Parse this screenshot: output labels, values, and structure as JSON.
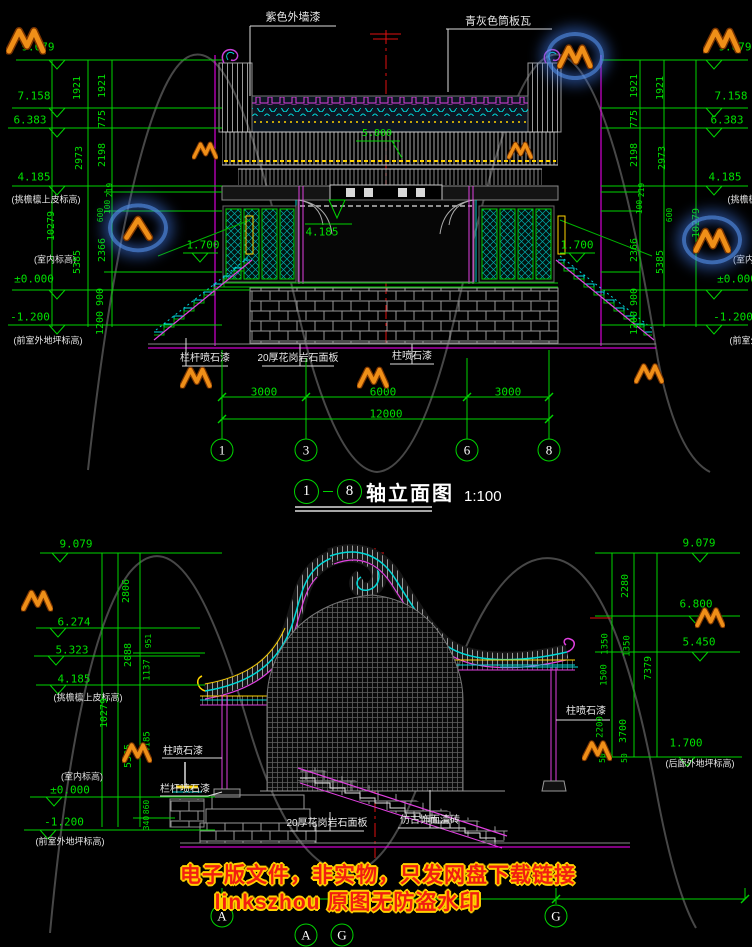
{
  "titles": {
    "top": {
      "from": "1",
      "to": "8",
      "text": "轴立面图",
      "scale": "1:100"
    }
  },
  "axes": {
    "top": [
      {
        "label": "1",
        "x": 222
      },
      {
        "label": "3",
        "x": 306
      },
      {
        "label": "6",
        "x": 467
      },
      {
        "label": "8",
        "x": 549
      }
    ],
    "top_y": 450,
    "bottom": [
      {
        "label": "A",
        "x": 222,
        "y": 916
      },
      {
        "label": "G",
        "x": 556,
        "y": 916
      },
      {
        "label": "A",
        "x": 306,
        "y": 935
      },
      {
        "label": "G",
        "x": 342,
        "y": 935
      }
    ]
  },
  "watermark": {
    "line1": "电子版文件，非实物，只发网盘下载链接",
    "line2": "linkszhou 原图无防盗水印",
    "logo_color": "#ef8f18",
    "glow_color": "#4a86d8",
    "logos": [
      {
        "x": 26,
        "y": 40,
        "s": 40
      },
      {
        "x": 575,
        "y": 56,
        "s": 36,
        "glow": 1
      },
      {
        "x": 722,
        "y": 40,
        "s": 38
      },
      {
        "x": 205,
        "y": 150,
        "s": 26
      },
      {
        "x": 520,
        "y": 150,
        "s": 26
      },
      {
        "x": 138,
        "y": 228,
        "s": 38,
        "glow": 1,
        "type": "chev"
      },
      {
        "x": 712,
        "y": 240,
        "s": 38,
        "glow": 1
      },
      {
        "x": 196,
        "y": 377,
        "s": 32
      },
      {
        "x": 373,
        "y": 377,
        "s": 32
      },
      {
        "x": 649,
        "y": 373,
        "s": 30
      },
      {
        "x": 37,
        "y": 600,
        "s": 32
      },
      {
        "x": 137,
        "y": 752,
        "s": 30
      },
      {
        "x": 597,
        "y": 750,
        "s": 30
      },
      {
        "x": 710,
        "y": 617,
        "s": 30
      }
    ]
  },
  "annotations": [
    {
      "n": "label-purple-wall-paint",
      "t": "紫色外墙漆",
      "x": 293,
      "y": 18,
      "c": "w",
      "s": 11
    },
    {
      "n": "label-grey-tube-tile",
      "t": "青灰色筒板瓦",
      "x": 498,
      "y": 22,
      "c": "w",
      "s": 11
    },
    {
      "n": "level-top-left-9079",
      "t": "9.079",
      "x": 38,
      "y": 47,
      "c": "gl"
    },
    {
      "n": "level-top-left-7158",
      "t": "7.158",
      "x": 34,
      "y": 96,
      "c": "gl"
    },
    {
      "n": "level-top-left-6383",
      "t": "6.383",
      "x": 30,
      "y": 120,
      "c": "gl"
    },
    {
      "n": "level-top-left-4185",
      "t": "4.185",
      "x": 34,
      "y": 177,
      "c": "gl"
    },
    {
      "n": "note-top-left-eave",
      "t": "(挑檐檩上皮标高)",
      "x": 46,
      "y": 200,
      "c": "w",
      "s": 9
    },
    {
      "n": "note-top-left-indoor",
      "t": "(室内标高)",
      "x": 55,
      "y": 260,
      "c": "w",
      "s": 9
    },
    {
      "n": "level-top-left-0000",
      "t": "±0.000",
      "x": 34,
      "y": 279,
      "c": "gl"
    },
    {
      "n": "level-top-left-m1200",
      "t": "-1.200",
      "x": 30,
      "y": 317,
      "c": "gl"
    },
    {
      "n": "note-top-left-ground",
      "t": "(前室外地坪标高)",
      "x": 48,
      "y": 341,
      "c": "w",
      "s": 9
    },
    {
      "n": "dim-top-left",
      "t": "1921",
      "x": 78,
      "y": 88,
      "r": 1
    },
    {
      "n": "dim-top-left",
      "t": "2973",
      "x": 80,
      "y": 158,
      "r": 1
    },
    {
      "n": "dim-top-left",
      "t": "5385",
      "x": 78,
      "y": 262,
      "r": 1
    },
    {
      "n": "dim-top-left-total",
      "t": "10279",
      "x": 52,
      "y": 226,
      "r": 1
    },
    {
      "n": "dim-top-left",
      "t": "1921",
      "x": 103,
      "y": 86,
      "r": 1
    },
    {
      "n": "dim-top-left",
      "t": "775",
      "x": 103,
      "y": 119,
      "r": 1
    },
    {
      "n": "dim-top-left",
      "t": "2198",
      "x": 103,
      "y": 155,
      "r": 1
    },
    {
      "n": "dim-top-left",
      "t": "219",
      "x": 110,
      "y": 190,
      "r": 1,
      "s": 8
    },
    {
      "n": "dim-top-left",
      "t": "100",
      "x": 108,
      "y": 207,
      "r": 1,
      "s": 8
    },
    {
      "n": "dim-top-left",
      "t": "600",
      "x": 101,
      "y": 215,
      "r": 1,
      "s": 8
    },
    {
      "n": "dim-top-left",
      "t": "2366",
      "x": 103,
      "y": 250,
      "r": 1
    },
    {
      "n": "dim-top-left",
      "t": "900",
      "x": 101,
      "y": 297,
      "r": 1
    },
    {
      "n": "dim-top-left",
      "t": "1200",
      "x": 101,
      "y": 323,
      "r": 1
    },
    {
      "n": "level-top-right-9079",
      "t": "9.079",
      "x": 735,
      "y": 47,
      "c": "gl"
    },
    {
      "n": "level-top-right-7158",
      "t": "7.158",
      "x": 731,
      "y": 96,
      "c": "gl"
    },
    {
      "n": "level-top-right-6383",
      "t": "6.383",
      "x": 727,
      "y": 120,
      "c": "gl"
    },
    {
      "n": "level-top-right-4185",
      "t": "4.185",
      "x": 725,
      "y": 177,
      "c": "gl"
    },
    {
      "n": "note-top-right-eave",
      "t": "(挑檐檩上皮标高)",
      "x": 762,
      "y": 200,
      "c": "w",
      "s": 9
    },
    {
      "n": "note-top-right-indoor",
      "t": "(室内标高)",
      "x": 754,
      "y": 260,
      "c": "w",
      "s": 9
    },
    {
      "n": "level-top-right-0000",
      "t": "±0.000",
      "x": 737,
      "y": 279,
      "c": "gl"
    },
    {
      "n": "level-top-right-m1200",
      "t": "-1.200",
      "x": 733,
      "y": 317,
      "c": "gl"
    },
    {
      "n": "note-top-right-ground",
      "t": "(前室外地坪标高)",
      "x": 764,
      "y": 341,
      "c": "w",
      "s": 9
    },
    {
      "n": "dim-top-right",
      "t": "1921",
      "x": 635,
      "y": 86,
      "r": 1
    },
    {
      "n": "dim-top-right",
      "t": "775",
      "x": 635,
      "y": 119,
      "r": 1
    },
    {
      "n": "dim-top-right",
      "t": "2198",
      "x": 635,
      "y": 155,
      "r": 1
    },
    {
      "n": "dim-top-right",
      "t": "219",
      "x": 642,
      "y": 190,
      "r": 1,
      "s": 8
    },
    {
      "n": "dim-top-right",
      "t": "100",
      "x": 640,
      "y": 207,
      "r": 1,
      "s": 8
    },
    {
      "n": "dim-top-right",
      "t": "2366",
      "x": 635,
      "y": 250,
      "r": 1
    },
    {
      "n": "dim-top-right",
      "t": "900",
      "x": 635,
      "y": 297,
      "r": 1
    },
    {
      "n": "dim-top-right",
      "t": "1200",
      "x": 635,
      "y": 323,
      "r": 1
    },
    {
      "n": "dim-top-right",
      "t": "1921",
      "x": 661,
      "y": 88,
      "r": 1
    },
    {
      "n": "dim-top-right",
      "t": "2973",
      "x": 663,
      "y": 158,
      "r": 1
    },
    {
      "n": "dim-top-right",
      "t": "600",
      "x": 670,
      "y": 215,
      "r": 1,
      "s": 8
    },
    {
      "n": "dim-top-right",
      "t": "5385",
      "x": 661,
      "y": 262,
      "r": 1
    },
    {
      "n": "dim-top-right-total",
      "t": "10279",
      "x": 697,
      "y": 223,
      "r": 1
    },
    {
      "n": "level-stair-left",
      "t": "1.700",
      "x": 203,
      "y": 245,
      "c": "gl"
    },
    {
      "n": "level-stair-right",
      "t": "1.700",
      "x": 577,
      "y": 245,
      "c": "gl"
    },
    {
      "n": "level-ridge",
      "t": "5.800",
      "x": 377,
      "y": 134,
      "c": "gl",
      "s": 10
    },
    {
      "n": "level-beam",
      "t": "4.185",
      "x": 322,
      "y": 232,
      "c": "gl",
      "s": 11
    },
    {
      "n": "label-railing-paint-top",
      "t": "栏杆喷石漆",
      "x": 205,
      "y": 359,
      "c": "w"
    },
    {
      "n": "label-granite-panel-top",
      "t": "20厚花岗岩石面板",
      "x": 298,
      "y": 359,
      "c": "w"
    },
    {
      "n": "label-column-paint-top",
      "t": "柱喷石漆",
      "x": 412,
      "y": 357,
      "c": "w"
    },
    {
      "n": "dim-span",
      "t": "3000",
      "x": 264,
      "y": 392,
      "c": "g",
      "s": 11
    },
    {
      "n": "dim-span",
      "t": "6000",
      "x": 383,
      "y": 392,
      "c": "g",
      "s": 11
    },
    {
      "n": "dim-span",
      "t": "3000",
      "x": 508,
      "y": 392,
      "c": "g",
      "s": 11
    },
    {
      "n": "dim-span-total",
      "t": "12000",
      "x": 386,
      "y": 414,
      "c": "g",
      "s": 11
    },
    {
      "n": "level-bot-left-9079",
      "t": "9.079",
      "x": 76,
      "y": 544,
      "c": "gl"
    },
    {
      "n": "level-bot-left-6274",
      "t": "6.274",
      "x": 74,
      "y": 622,
      "c": "gl"
    },
    {
      "n": "level-bot-left-5323",
      "t": "5.323",
      "x": 72,
      "y": 650,
      "c": "gl"
    },
    {
      "n": "level-bot-left-4185",
      "t": "4.185",
      "x": 74,
      "y": 679,
      "c": "gl"
    },
    {
      "n": "note-bot-left-eave",
      "t": "(挑檐檩上皮标高)",
      "x": 88,
      "y": 698,
      "c": "w",
      "s": 9
    },
    {
      "n": "note-bot-left-indoor",
      "t": "(室内标高)",
      "x": 82,
      "y": 777,
      "c": "w",
      "s": 9
    },
    {
      "n": "level-bot-left-0000",
      "t": "±0.000",
      "x": 70,
      "y": 790,
      "c": "gl"
    },
    {
      "n": "level-bot-left-m1200",
      "t": "-1.200",
      "x": 64,
      "y": 822,
      "c": "gl"
    },
    {
      "n": "note-bot-left-ground",
      "t": "(前室外地坪标高)",
      "x": 70,
      "y": 842,
      "c": "w",
      "s": 9
    },
    {
      "n": "dim-bot-left",
      "t": "2806",
      "x": 127,
      "y": 591,
      "r": 1
    },
    {
      "n": "dim-bot-left",
      "t": "2088",
      "x": 129,
      "y": 655,
      "r": 1
    },
    {
      "n": "dim-bot-left",
      "t": "951",
      "x": 149,
      "y": 641,
      "r": 1,
      "s": 8
    },
    {
      "n": "dim-bot-left",
      "t": "1137",
      "x": 148,
      "y": 670,
      "r": 1,
      "s": 9
    },
    {
      "n": "dim-bot-left-total",
      "t": "10279",
      "x": 105,
      "y": 713,
      "r": 1
    },
    {
      "n": "dim-bot-left",
      "t": "5385",
      "x": 129,
      "y": 756,
      "r": 1
    },
    {
      "n": "dim-bot-left",
      "t": "4185",
      "x": 148,
      "y": 742,
      "r": 1,
      "s": 9
    },
    {
      "n": "dim-bot-left",
      "t": "860",
      "x": 147,
      "y": 807,
      "r": 1,
      "s": 8
    },
    {
      "n": "dim-bot-left",
      "t": "340",
      "x": 147,
      "y": 823,
      "r": 1,
      "s": 8
    },
    {
      "n": "level-bot-right-9079",
      "t": "9.079",
      "x": 699,
      "y": 543,
      "c": "gl"
    },
    {
      "n": "level-bot-right-6800",
      "t": "6.800",
      "x": 696,
      "y": 604,
      "c": "gl"
    },
    {
      "n": "level-bot-right-5450",
      "t": "5.450",
      "x": 699,
      "y": 642,
      "c": "gl"
    },
    {
      "n": "level-bot-right-1700",
      "t": "1.700",
      "x": 686,
      "y": 743,
      "c": "gl"
    },
    {
      "n": "note-bot-right-ground",
      "t": "(后廊外地坪标高)",
      "x": 700,
      "y": 764,
      "c": "w",
      "s": 9
    },
    {
      "n": "dim-bot-right",
      "t": "2280",
      "x": 626,
      "y": 586,
      "r": 1
    },
    {
      "n": "dim-bot-right",
      "t": "1350",
      "x": 606,
      "y": 644,
      "r": 1,
      "s": 9
    },
    {
      "n": "dim-bot-right",
      "t": "1350",
      "x": 628,
      "y": 646,
      "r": 1,
      "s": 9
    },
    {
      "n": "dim-bot-right",
      "t": "1500",
      "x": 605,
      "y": 675,
      "r": 1,
      "s": 9
    },
    {
      "n": "dim-bot-right-total",
      "t": "7379",
      "x": 649,
      "y": 668,
      "r": 1
    },
    {
      "n": "dim-bot-right",
      "t": "2200",
      "x": 601,
      "y": 727,
      "r": 1,
      "s": 9
    },
    {
      "n": "dim-bot-right",
      "t": "3700",
      "x": 624,
      "y": 731,
      "r": 1
    },
    {
      "n": "dim-bot-right",
      "t": "50",
      "x": 603,
      "y": 758,
      "r": 1,
      "s": 8
    },
    {
      "n": "dim-bot-right",
      "t": "50",
      "x": 625,
      "y": 758,
      "r": 1,
      "s": 8
    },
    {
      "n": "label-column-paint-bot-left",
      "t": "柱喷石漆",
      "x": 183,
      "y": 752,
      "c": "w"
    },
    {
      "n": "label-railing-paint-bot",
      "t": "栏杆喷石漆",
      "x": 185,
      "y": 790,
      "c": "w"
    },
    {
      "n": "label-granite-panel-bot",
      "t": "20厚花岗岩石面板",
      "x": 327,
      "y": 824,
      "c": "w"
    },
    {
      "n": "label-antique-brick",
      "t": "仿古饰面清砖",
      "x": 430,
      "y": 821,
      "c": "w"
    },
    {
      "n": "label-column-paint-bot-right",
      "t": "柱喷石漆",
      "x": 586,
      "y": 712,
      "c": "w"
    }
  ]
}
